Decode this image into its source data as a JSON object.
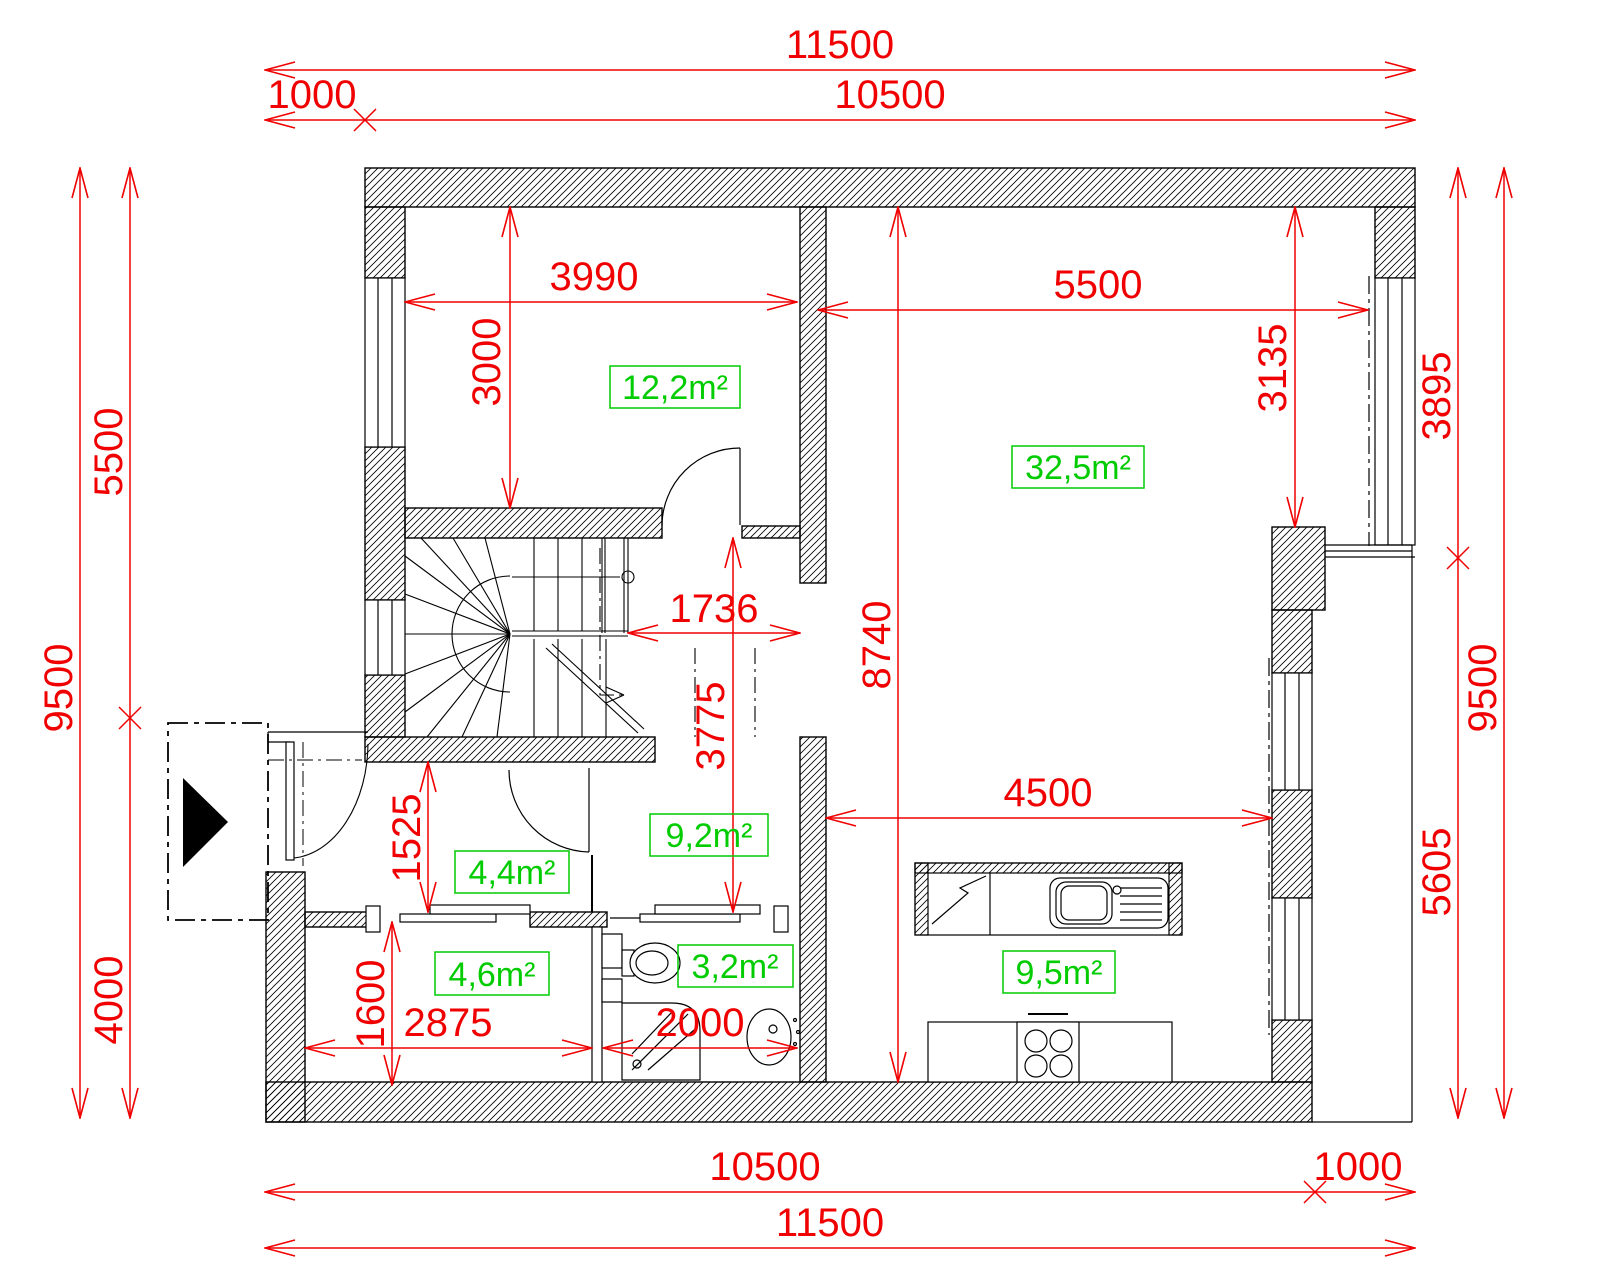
{
  "drawing": {
    "type_label": "floor-plan",
    "colors": {
      "dimension_red": "#f00000",
      "area_green": "#00cc00",
      "wall_black": "#000000",
      "background": "#ffffff"
    }
  },
  "dims": {
    "top_overall": "11500",
    "top_offset": "1000",
    "top_main": "10500",
    "bottom_main": "10500",
    "bottom_offset": "1000",
    "bottom_overall": "11500",
    "left_overall": "9500",
    "left_upper": "5500",
    "left_lower": "4000",
    "right_upper": "3895",
    "right_overall": "9500",
    "right_lower": "5605",
    "bedroom_width": "3990",
    "bedroom_height": "3000",
    "living_width": "5500",
    "living_right_height": "3135",
    "living_full_height": "8740",
    "hall_width": "1736",
    "hall_height": "3775",
    "vestibule_height": "1525",
    "storage_height": "1600",
    "storage_width": "2875",
    "bathroom_width": "2000",
    "kitchen_width": "4500"
  },
  "areas": {
    "bedroom": "12,2m²",
    "living": "32,5m²",
    "hall": "9,2m²",
    "vestibule": "4,4m²",
    "storage": "4,6m²",
    "bathroom": "3,2m²",
    "kitchen": "9,5m²"
  }
}
